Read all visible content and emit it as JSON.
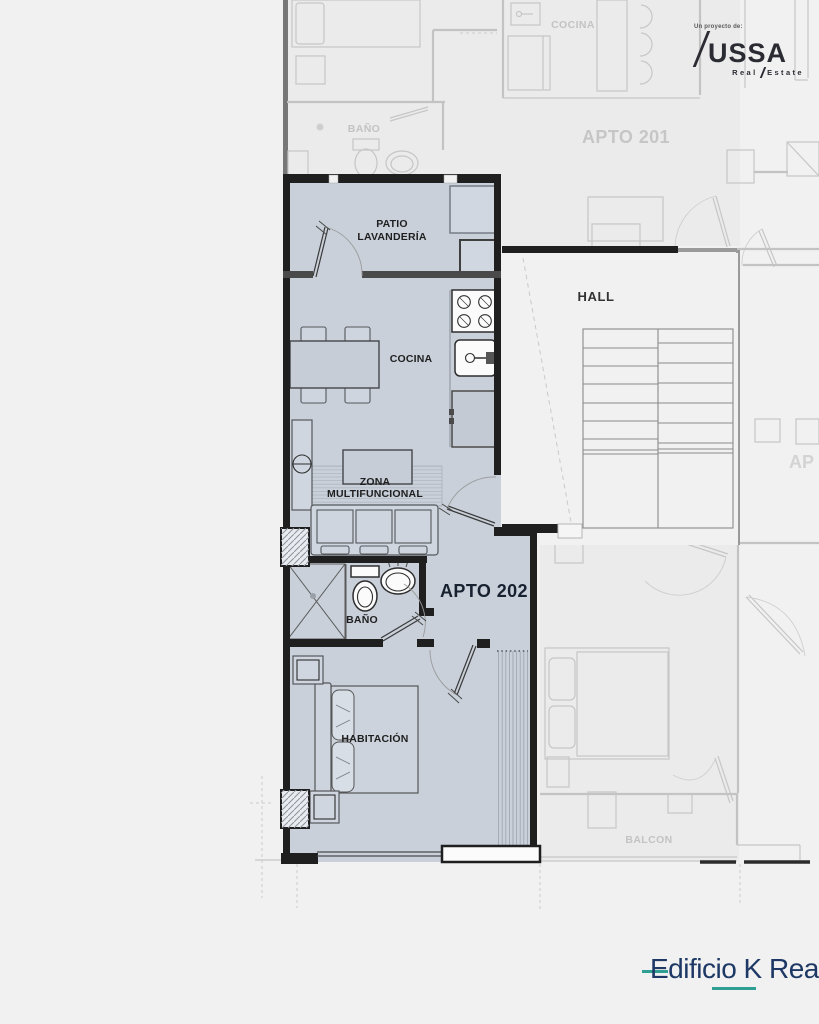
{
  "branding": {
    "presented_by": "Un proyecto de:",
    "brand_name": "USSA",
    "brand_tagline_left": "Real",
    "brand_tagline_right": "Estate",
    "building_name": "Edificio K Real"
  },
  "unit": {
    "label": "APTO 202",
    "rooms": {
      "patio_line1": "PATIO",
      "patio_line2": "LAVANDERÍA",
      "cocina": "COCINA",
      "zona_line1": "ZONA",
      "zona_line2": "MULTIFUNCIONAL",
      "bano": "BAÑO",
      "habitacion": "HABITACIÓN"
    }
  },
  "context": {
    "hall": "HALL",
    "apto_201": "APTO 201",
    "apto_201_cocina": "COCINA",
    "apto_201_bano": "BAÑO",
    "balcon": "BALCON",
    "apto_partial": "AP"
  },
  "colors": {
    "background": "#f1f1f1",
    "unit_fill": "#c9d0da",
    "fixture_fill": "#fbfbfb",
    "wall_dark": "#1f1f1f",
    "wall_medium": "#4a4a4a",
    "faded_line": "#c6c6c6",
    "faded_fill": "#ebebeb",
    "faded_text": "#c5c5c5",
    "label_text": "#1f1f1f",
    "brand_dark": "#2b2b33",
    "brand_navy": "#1d3864",
    "brand_teal": "#2f9f93"
  }
}
